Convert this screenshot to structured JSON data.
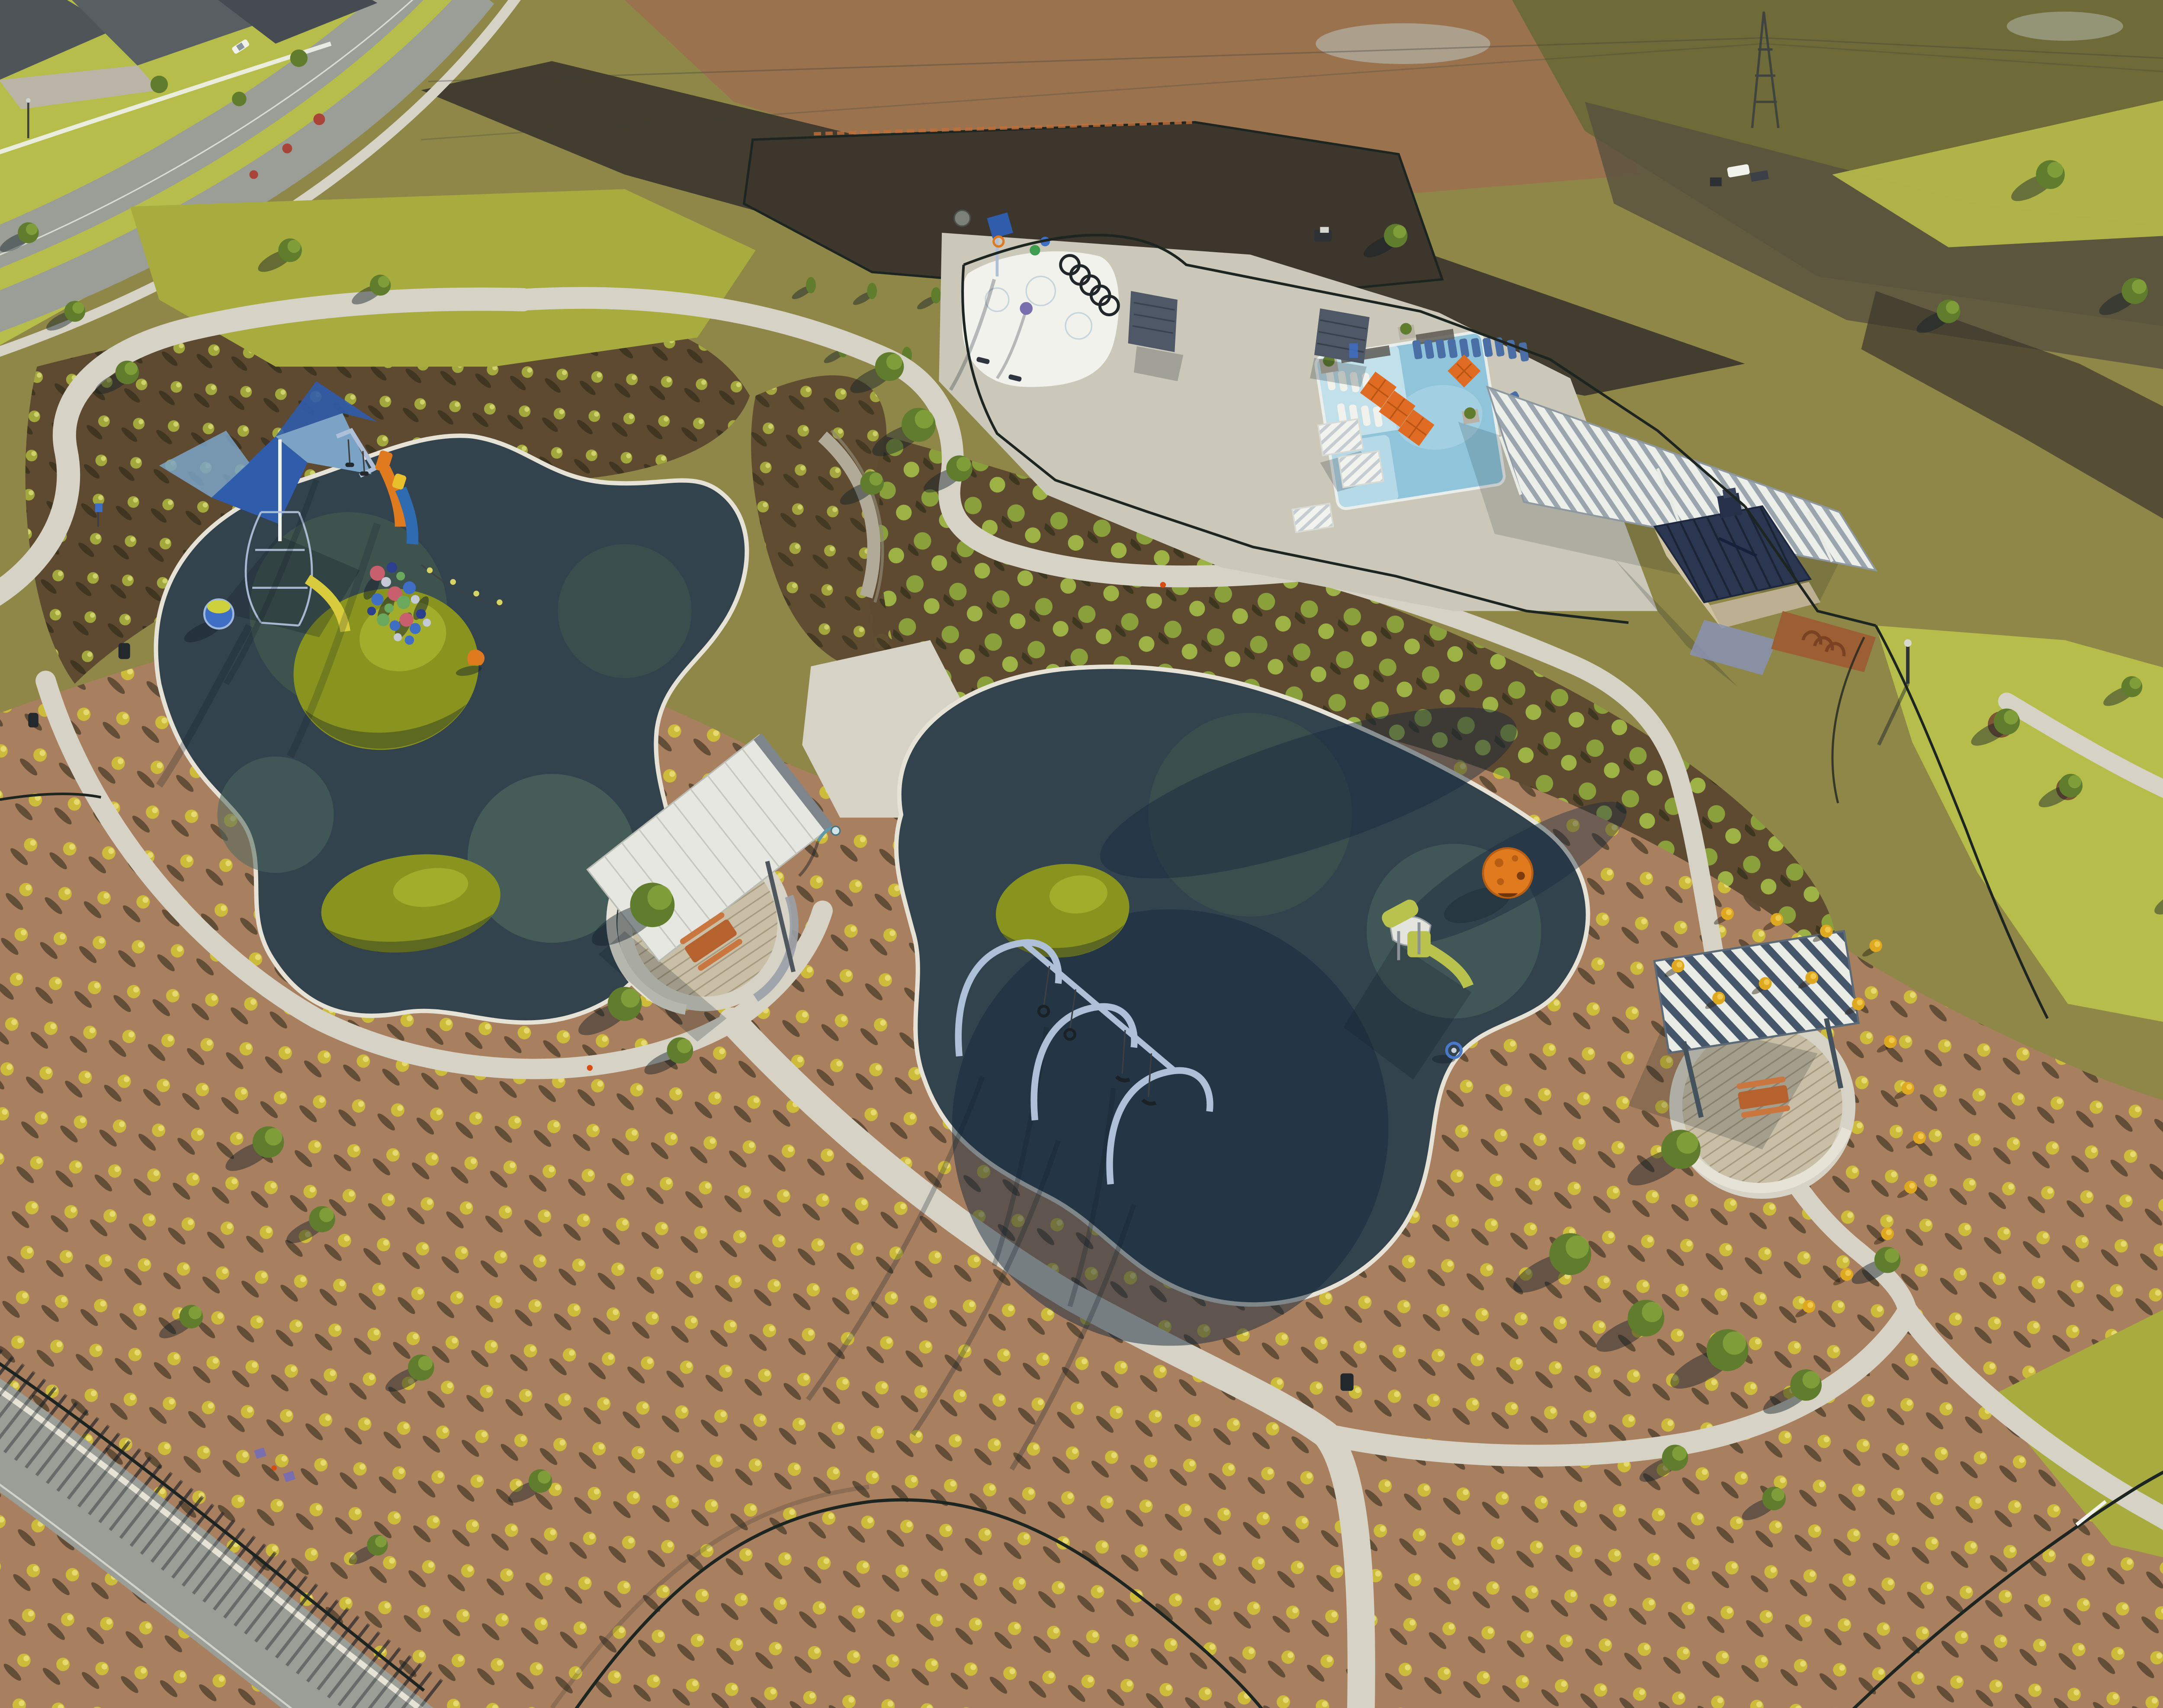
{
  "scene": {
    "description": "Aerial drone photograph of a newly built community park at low sun, long shadows cast to the lower left",
    "areas": [
      {
        "label": "residential street and rooftops",
        "position": "top-left"
      },
      {
        "label": "construction dirt fields with fenced enclosure and skid steer",
        "position": "top-center"
      },
      {
        "label": "transmission pylon with white utility pickup",
        "position": "top-right"
      },
      {
        "label": "splash pad with dump bucket, spray hoops and pergolas",
        "position": "upper-center"
      },
      {
        "label": "swimming pool with tanning ledge, orange umbrellas, loungers and louvered pavilion",
        "position": "upper-right"
      },
      {
        "label": "pool house with navy standing-seam hip roof",
        "position": "right"
      },
      {
        "label": "west playground lobe: shade sails, net tower, twin slides, play balls, globe spinner, turf mounds",
        "position": "center-left"
      },
      {
        "label": "picnic pavilion with slanted roof and picnic table",
        "position": "center"
      },
      {
        "label": "east playground lobe: arch swing set, lime play structure, orange climbing dome",
        "position": "center-right"
      },
      {
        "label": "picnic shelter with striped roof",
        "position": "right-of-center"
      },
      {
        "label": "ornamental grass planting beds in mulch",
        "position": "surrounding"
      },
      {
        "label": "black ornamental fencing and curving concrete paths",
        "position": "throughout"
      },
      {
        "label": "boulevard road with planted median",
        "position": "bottom-left"
      }
    ],
    "counts": {
      "orange_umbrellas": 4,
      "swing_seats": 4,
      "swing_arches": 3,
      "bollard_lights": 7,
      "shade_sails": 2,
      "turf_mounds": 3,
      "play_balls": 19,
      "white_in_water_loungers": 8,
      "blue_loungers": 14,
      "pergolas": 4,
      "picnic_tables": 2
    }
  },
  "palette": {
    "field_olive": "#8f8747",
    "field_olive_dark": "#6f6b38",
    "field_red": "#9c7050",
    "soil_dark": "#3c362c",
    "soil_mid": "#57503e",
    "lawn": "#a8ab3e",
    "lawn_bright": "#b7bd4a",
    "meadow_green": "#8aa03a",
    "mulch": "#7c5534",
    "mulch_pink": "#a9805f",
    "mulch_dark": "#5d4a30",
    "tuft_gold": "#cdbb3a",
    "tuft_olive": "#a3a83c",
    "shrub_gold": "#dfa91f",
    "tree_green": "#5f7d2c",
    "tree_light": "#8aa83e",
    "concrete": "#d6d3c6",
    "deck": "#cbc8ba",
    "road": "#9b9e96",
    "rubber_dark": "#32434e",
    "rubber_mid": "#41564f",
    "rubber_green": "#4e665c",
    "rubber_navy": "#16293e",
    "mound": "#89941f",
    "mound_light": "#aab32f",
    "pool": "#8fc4da",
    "pool_light": "#c2e0ea",
    "umbrella": "#e06c24",
    "lounger_blue": "#4a6ea6",
    "white": "#f1f2ec",
    "roof_navy": "#2b3750",
    "wall_cream": "#cfc2a0",
    "stone_wall": "#b2aa98",
    "slat_gray": "#4e5866",
    "orange": "#e07a1e",
    "lime": "#b9c24c",
    "sail_blue": "#2f5cab",
    "sail_light": "#7ba3c6",
    "purple": "#7a6fae",
    "wood_red": "#b5622f",
    "dg_brown": "#9c5f33",
    "curb": "#e6e3d6",
    "fence": "#1d2521",
    "shadow": "rgba(18,30,40,0.45)",
    "steel_blue": "#aebfd8",
    "wire": "#3c4040",
    "ball_colors": [
      "#c75f6c",
      "#3f6fc4",
      "#6aa85e",
      "#c3cad6",
      "#2c3f8f"
    ]
  }
}
